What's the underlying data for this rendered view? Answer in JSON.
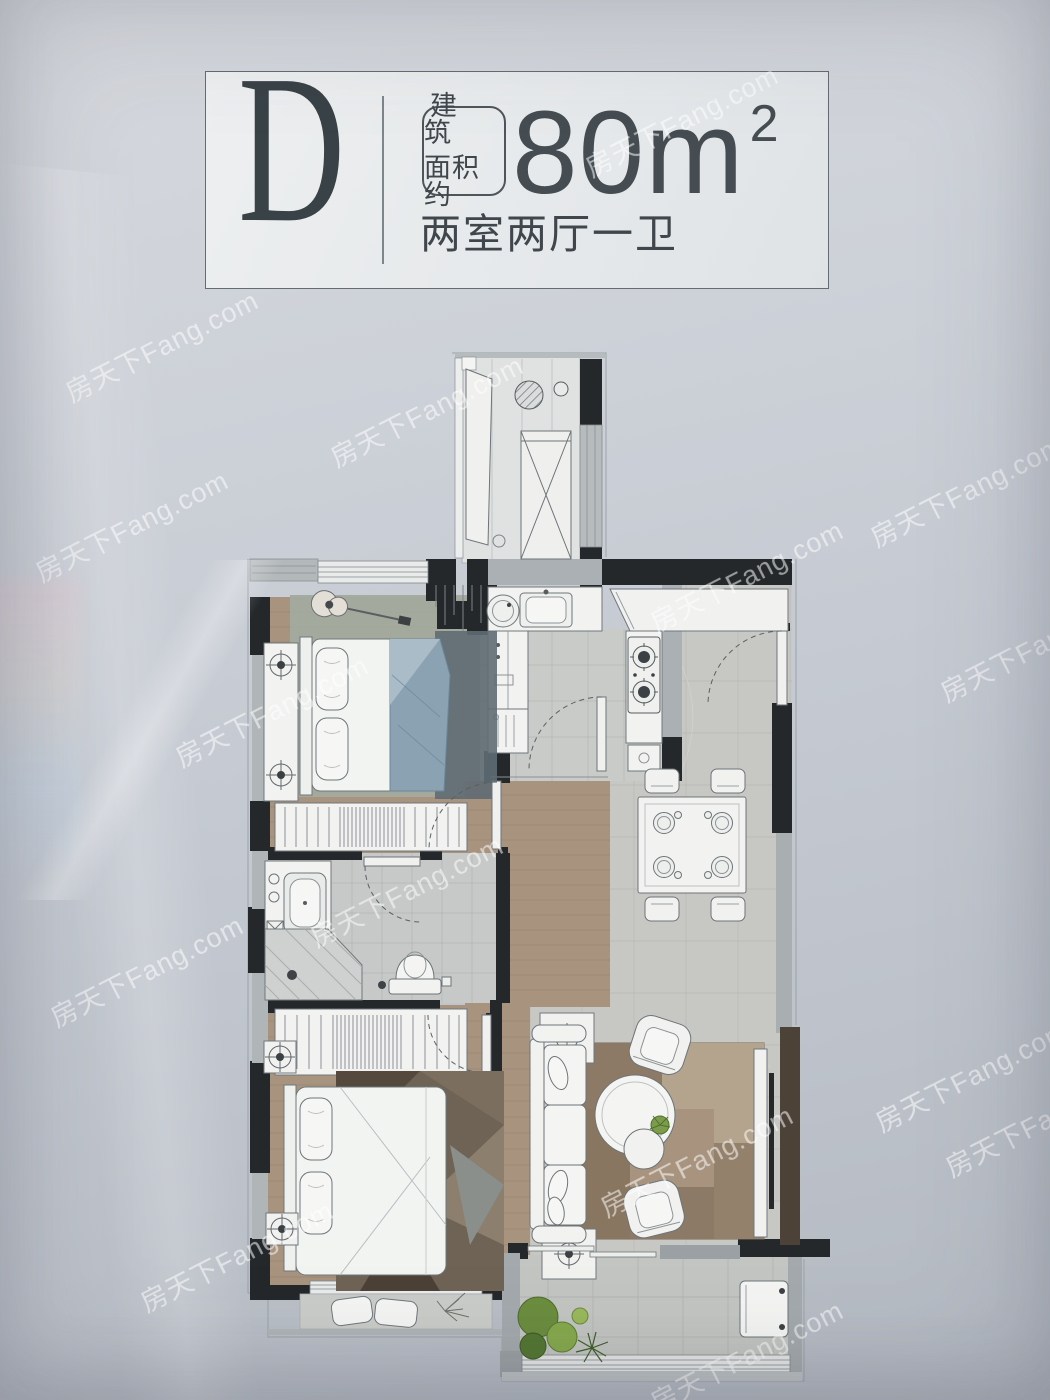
{
  "header": {
    "unit_label": "D",
    "area_badge": {
      "line1": "建 筑",
      "line2": "面积约"
    },
    "area_value": "80",
    "area_unit": "m",
    "area_superscript": "2",
    "layout_text": "两室两厅一卫"
  },
  "watermark": {
    "text": "房天下Fang.com"
  },
  "palette": {
    "background": "#c6cbd2",
    "panel": "#e9ebec",
    "ink": "#3f474c",
    "wall_dark": "#24282b",
    "wall_gray": "#a9aeb1",
    "wall_brown": "#4c4238",
    "wood_floor": "#a8937f",
    "marble_floor": "#c7c8c4",
    "bedding_blue": "#8ba2b2",
    "rug_brown": "#a2917c",
    "plant_green": "#6b8d3e"
  }
}
